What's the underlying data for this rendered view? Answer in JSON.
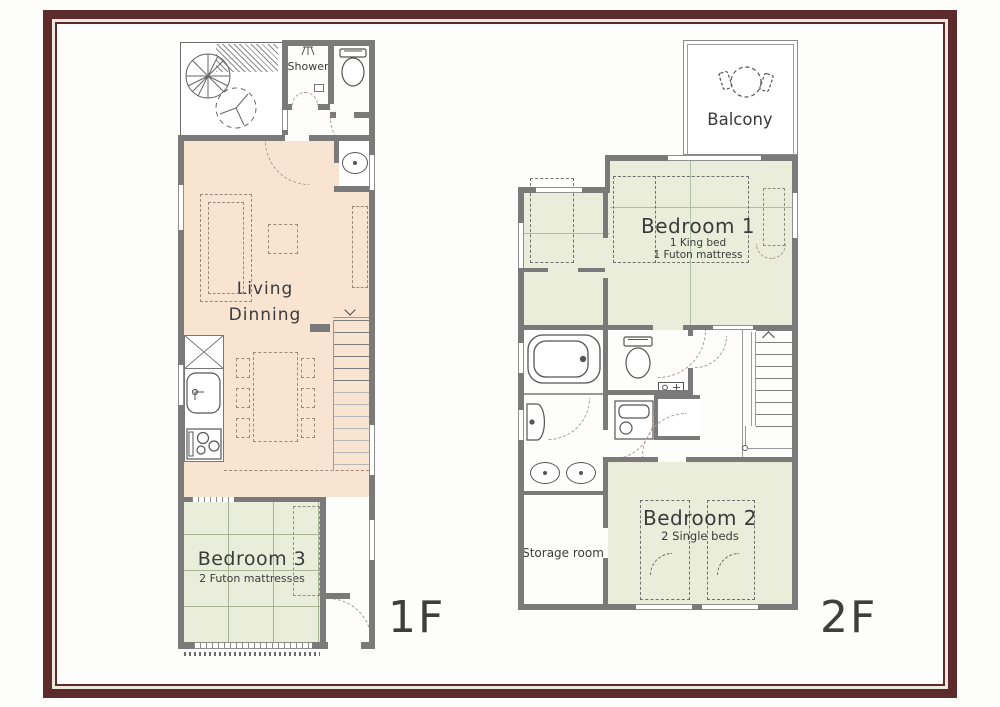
{
  "document": {
    "type": "house floor plan"
  },
  "colors": {
    "frame": "#5e2b2c",
    "frame_gap": "#efe8dc",
    "wall": "#7a7a7a",
    "living_floor": "#f9e4d2",
    "tatami_floor": "#e9edda",
    "label_text": "#3b3b3b"
  },
  "floor1": {
    "floor_label": "1F",
    "shower_label": "Shower",
    "living_label_line1": "Living",
    "living_label_line2": "Dinning",
    "bedroom3_label": "Bedroom 3",
    "bedroom3_sublabel": "2 Futon mattresses"
  },
  "floor2": {
    "floor_label": "2F",
    "balcony_label": "Balcony",
    "bedroom1_label": "Bedroom 1",
    "bedroom1_sublabel1": "1 King bed",
    "bedroom1_sublabel2": "1 Futon mattress",
    "bedroom2_label": "Bedroom 2",
    "bedroom2_sublabel": "2 Single beds",
    "storage_label": "Storage room"
  }
}
